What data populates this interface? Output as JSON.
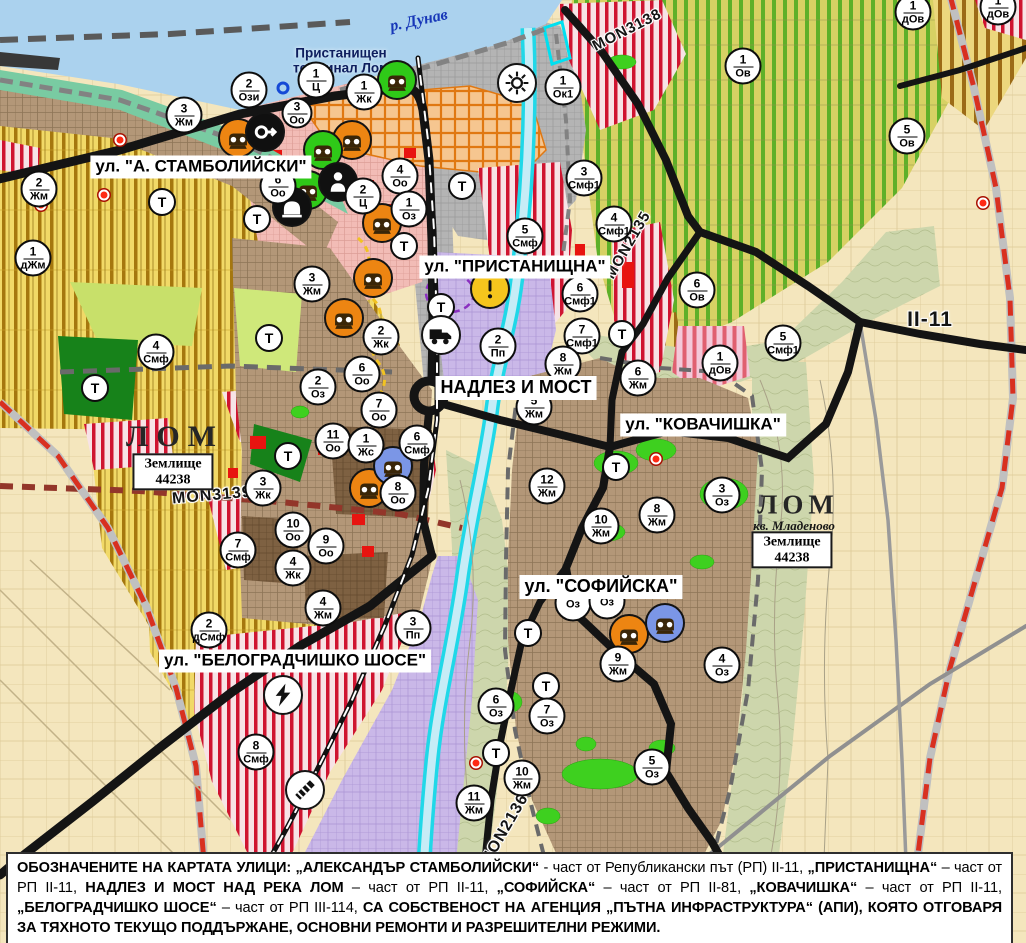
{
  "street_labels": [
    {
      "text": "ул. \"А. СТАМБОЛИЙСКИ\"",
      "x": 201,
      "y": 167,
      "fs": 17,
      "name": "street-label-stamboliyski"
    },
    {
      "text": "ул. \"ПРИСТАНИЩНА\"",
      "x": 515,
      "y": 267,
      "fs": 17,
      "name": "street-label-pristanishtna"
    },
    {
      "text": "НАДЛЕЗ И МОСТ",
      "x": 516,
      "y": 388,
      "fs": 18,
      "name": "street-label-nadlez-i-most"
    },
    {
      "text": "ул. \"КОВАЧИШКА\"",
      "x": 703,
      "y": 425,
      "fs": 17,
      "name": "street-label-kovachishka"
    },
    {
      "text": "ул. \"СОФИЙСКА\"",
      "x": 601,
      "y": 587,
      "fs": 18,
      "name": "street-label-sofiyska"
    },
    {
      "text": "ул. \"БЕЛОГРАДЧИШКО ШОСЕ\"",
      "x": 295,
      "y": 661,
      "fs": 17,
      "name": "street-label-belogradchishko"
    }
  ],
  "road_labels": [
    {
      "text": "MON3139",
      "x": 212,
      "y": 496,
      "rot": -5,
      "fs": 16,
      "name": "road-code-mon3139"
    },
    {
      "text": "MON2135",
      "x": 628,
      "y": 245,
      "rot": -60,
      "fs": 15,
      "name": "road-code-mon2135"
    },
    {
      "text": "MON3138",
      "x": 627,
      "y": 30,
      "rot": -27,
      "fs": 15,
      "name": "road-code-mon3138"
    },
    {
      "text": "II-11",
      "x": 930,
      "y": 320,
      "rot": 0,
      "fs": 21,
      "name": "road-code-ii-11"
    },
    {
      "text": "MON2136",
      "x": 505,
      "y": 830,
      "rot": -60,
      "fs": 16,
      "name": "road-code-mon2136"
    }
  ],
  "place_labels": [
    {
      "text": "р. Дунав",
      "x": 419,
      "y": 21,
      "rot": -12,
      "fs": 16,
      "cls": "pl-river",
      "name": "river-danube-label"
    },
    {
      "text": "Пристанищен\nтерминал Лом",
      "x": 341,
      "y": 53,
      "fs": 13.5,
      "cls": "pl-terminal",
      "name": "port-terminal-label"
    },
    {
      "text": "ЛОМ",
      "x": 175,
      "y": 437,
      "fs": 30,
      "ls": 8,
      "cls": "pl-city",
      "name": "city-label-lom-west"
    },
    {
      "text": "ЛОМ",
      "x": 798,
      "y": 505,
      "fs": 27,
      "ls": 5,
      "cls": "pl-city",
      "name": "city-label-lom-east"
    },
    {
      "text": "кв. Младеново",
      "x": 794,
      "y": 526,
      "fs": 13,
      "cls": "pl-kv",
      "name": "kvartal-mladenovo-label"
    }
  ],
  "zemlishte_boxes": [
    {
      "x": 173,
      "y": 472,
      "line1": "Землище",
      "line2": "44238"
    },
    {
      "x": 792,
      "y": 550,
      "line1": "Землище",
      "line2": "44238"
    }
  ],
  "zone_markers": [
    {
      "x": 249,
      "y": 90,
      "n": "2",
      "c": "Ози"
    },
    {
      "x": 316,
      "y": 80,
      "n": "1",
      "c": "Ц"
    },
    {
      "x": 297,
      "y": 113,
      "n": "3",
      "c": "Оо",
      "cls": "sm"
    },
    {
      "x": 364,
      "y": 92,
      "n": "1",
      "c": "Жк"
    },
    {
      "x": 563,
      "y": 87,
      "n": "1",
      "c": "Ок1"
    },
    {
      "x": 184,
      "y": 115,
      "n": "3",
      "c": "Жм"
    },
    {
      "x": 400,
      "y": 176,
      "n": "4",
      "c": "Оо"
    },
    {
      "x": 363,
      "y": 196,
      "n": "2",
      "c": "Ц"
    },
    {
      "x": 409,
      "y": 209,
      "n": "1",
      "c": "Оз"
    },
    {
      "x": 278,
      "y": 186,
      "n": "6",
      "c": "Оо"
    },
    {
      "x": 39,
      "y": 189,
      "n": "2",
      "c": "Жм"
    },
    {
      "x": 33,
      "y": 258,
      "n": "1",
      "c": "дЖм"
    },
    {
      "x": 312,
      "y": 284,
      "n": "3",
      "c": "Жм"
    },
    {
      "x": 381,
      "y": 337,
      "n": "2",
      "c": "Жк"
    },
    {
      "x": 362,
      "y": 374,
      "n": "6",
      "c": "Оо"
    },
    {
      "x": 379,
      "y": 410,
      "n": "7",
      "c": "Оо"
    },
    {
      "x": 318,
      "y": 387,
      "n": "2",
      "c": "Оз"
    },
    {
      "x": 333,
      "y": 441,
      "n": "11",
      "c": "Оо"
    },
    {
      "x": 366,
      "y": 445,
      "n": "1",
      "c": "Жс"
    },
    {
      "x": 417,
      "y": 443,
      "n": "6",
      "c": "Смф"
    },
    {
      "x": 398,
      "y": 493,
      "n": "8",
      "c": "Оо"
    },
    {
      "x": 263,
      "y": 488,
      "n": "3",
      "c": "Жк"
    },
    {
      "x": 293,
      "y": 530,
      "n": "10",
      "c": "Оо"
    },
    {
      "x": 326,
      "y": 546,
      "n": "9",
      "c": "Оо"
    },
    {
      "x": 293,
      "y": 568,
      "n": "4",
      "c": "Жк"
    },
    {
      "x": 238,
      "y": 550,
      "n": "7",
      "c": "Смф"
    },
    {
      "x": 156,
      "y": 352,
      "n": "4",
      "c": "Смф"
    },
    {
      "x": 913,
      "y": 12,
      "n": "1",
      "c": "дОв"
    },
    {
      "x": 998,
      "y": 7,
      "n": "1",
      "c": "дОв"
    },
    {
      "x": 743,
      "y": 66,
      "n": "1",
      "c": "Ов"
    },
    {
      "x": 907,
      "y": 136,
      "n": "5",
      "c": "Ов"
    },
    {
      "x": 584,
      "y": 178,
      "n": "3",
      "c": "Смф1"
    },
    {
      "x": 614,
      "y": 224,
      "n": "4",
      "c": "Смф1"
    },
    {
      "x": 525,
      "y": 236,
      "n": "5",
      "c": "Смф"
    },
    {
      "x": 580,
      "y": 294,
      "n": "6",
      "c": "Смф1"
    },
    {
      "x": 582,
      "y": 336,
      "n": "7",
      "c": "Смф1"
    },
    {
      "x": 697,
      "y": 290,
      "n": "6",
      "c": "Ов"
    },
    {
      "x": 720,
      "y": 363,
      "n": "1",
      "c": "дОв"
    },
    {
      "x": 783,
      "y": 343,
      "n": "5",
      "c": "Смф1"
    },
    {
      "x": 498,
      "y": 346,
      "n": "2",
      "c": "Пп"
    },
    {
      "x": 534,
      "y": 407,
      "n": "5",
      "c": "Жм"
    },
    {
      "x": 563,
      "y": 364,
      "n": "8",
      "c": "Жм"
    },
    {
      "x": 638,
      "y": 378,
      "n": "6",
      "c": "Жм"
    },
    {
      "x": 547,
      "y": 486,
      "n": "12",
      "c": "Жм"
    },
    {
      "x": 601,
      "y": 526,
      "n": "10",
      "c": "Жм"
    },
    {
      "x": 657,
      "y": 515,
      "n": "8",
      "c": "Жм"
    },
    {
      "x": 722,
      "y": 495,
      "n": "3",
      "c": "Оз"
    },
    {
      "x": 618,
      "y": 664,
      "n": "9",
      "c": "Жм"
    },
    {
      "x": 722,
      "y": 665,
      "n": "4",
      "c": "Оз"
    },
    {
      "x": 496,
      "y": 706,
      "n": "6",
      "c": "Оз"
    },
    {
      "x": 547,
      "y": 716,
      "n": "7",
      "c": "Оз"
    },
    {
      "x": 652,
      "y": 767,
      "n": "5",
      "c": "Оз"
    },
    {
      "x": 522,
      "y": 778,
      "n": "10",
      "c": "Жм"
    },
    {
      "x": 474,
      "y": 803,
      "n": "11",
      "c": "Жм"
    },
    {
      "x": 209,
      "y": 630,
      "n": "2",
      "c": "дСмф"
    },
    {
      "x": 323,
      "y": 608,
      "n": "4",
      "c": "Жм"
    },
    {
      "x": 413,
      "y": 628,
      "n": "3",
      "c": "Пп"
    },
    {
      "x": 256,
      "y": 752,
      "n": "8",
      "c": "Смф"
    },
    {
      "x": 573,
      "y": 603,
      "n": "",
      "c": "Оз"
    },
    {
      "x": 607,
      "y": 601,
      "n": "",
      "c": "Оз"
    }
  ],
  "t_markers": [
    {
      "x": 162,
      "y": 202,
      "l": "Т"
    },
    {
      "x": 257,
      "y": 219,
      "l": "Т"
    },
    {
      "x": 269,
      "y": 338,
      "l": "Т"
    },
    {
      "x": 95,
      "y": 388,
      "l": "Т"
    },
    {
      "x": 288,
      "y": 456,
      "l": "Т"
    },
    {
      "x": 462,
      "y": 186,
      "l": "Т"
    },
    {
      "x": 404,
      "y": 246,
      "l": "Т"
    },
    {
      "x": 441,
      "y": 307,
      "l": "Т"
    },
    {
      "x": 622,
      "y": 334,
      "l": "Т"
    },
    {
      "x": 616,
      "y": 467,
      "l": "Т"
    },
    {
      "x": 528,
      "y": 633,
      "l": "Т"
    },
    {
      "x": 546,
      "y": 686,
      "l": "Т"
    },
    {
      "x": 496,
      "y": 753,
      "l": "Т"
    }
  ],
  "icon_markers": [
    {
      "x": 238,
      "y": 138,
      "icon": "factory",
      "bg": "#ed8512",
      "name": "factory-icon-marker"
    },
    {
      "x": 352,
      "y": 140,
      "icon": "factory",
      "bg": "#ed8512",
      "name": "factory-icon-marker"
    },
    {
      "x": 382,
      "y": 223,
      "icon": "factory",
      "bg": "#ed8512",
      "name": "factory-icon-marker"
    },
    {
      "x": 373,
      "y": 278,
      "icon": "factory",
      "bg": "#ed8512",
      "name": "factory-icon-marker"
    },
    {
      "x": 344,
      "y": 318,
      "icon": "factory",
      "bg": "#ed8512",
      "name": "factory-icon-marker"
    },
    {
      "x": 369,
      "y": 488,
      "icon": "factory",
      "bg": "#ed8512",
      "name": "factory-icon-marker"
    },
    {
      "x": 629,
      "y": 634,
      "icon": "factory",
      "bg": "#ed8512",
      "name": "factory-icon-marker"
    },
    {
      "x": 397,
      "y": 80,
      "icon": "factory",
      "bg": "#2fc918",
      "name": "factory-icon-marker-green"
    },
    {
      "x": 323,
      "y": 150,
      "icon": "factory",
      "bg": "#2fc918",
      "name": "factory-icon-marker-green"
    },
    {
      "x": 308,
      "y": 190,
      "icon": "factory",
      "bg": "#2fc918",
      "name": "factory-icon-marker-green"
    },
    {
      "x": 393,
      "y": 466,
      "icon": "factory",
      "bg": "#7b96e6",
      "name": "factory-icon-marker-blue"
    },
    {
      "x": 665,
      "y": 623,
      "icon": "factory",
      "bg": "#7b96e6",
      "name": "factory-icon-marker-blue"
    },
    {
      "x": 265,
      "y": 132,
      "icon": "key",
      "bg": "#101010",
      "name": "monument-icon-marker"
    },
    {
      "x": 338,
      "y": 182,
      "icon": "person",
      "bg": "#101010",
      "name": "person-icon-marker"
    },
    {
      "x": 292,
      "y": 207,
      "icon": "tunnel",
      "bg": "#101010",
      "name": "tunnel-icon-marker"
    },
    {
      "x": 517,
      "y": 83,
      "icon": "sun",
      "bg": "#ffffff",
      "name": "sun-icon-marker"
    },
    {
      "x": 490,
      "y": 289,
      "icon": "warning",
      "bg": "#f5c51d",
      "name": "warning-icon-marker"
    },
    {
      "x": 441,
      "y": 335,
      "icon": "truck",
      "bg": "#ffffff",
      "name": "truck-station-icon-marker"
    },
    {
      "x": 283,
      "y": 695,
      "icon": "lightning",
      "bg": "#ffffff",
      "name": "electric-substation-icon-marker"
    },
    {
      "x": 305,
      "y": 790,
      "icon": "crossing",
      "bg": "#ffffff",
      "name": "railway-crossing-icon-marker"
    }
  ],
  "dots": [
    {
      "x": 120,
      "y": 140,
      "cls": "red"
    },
    {
      "x": 41,
      "y": 205,
      "cls": "red"
    },
    {
      "x": 104,
      "y": 195,
      "cls": "red"
    },
    {
      "x": 656,
      "y": 459,
      "cls": "red"
    },
    {
      "x": 983,
      "y": 203,
      "cls": "red"
    },
    {
      "x": 476,
      "y": 763,
      "cls": "red"
    },
    {
      "x": 283,
      "y": 88,
      "cls": "blue"
    }
  ],
  "footer": {
    "segments": [
      {
        "t": "ОБОЗНАЧЕНИТЕ НА КАРТАТА УЛИЦИ: „АЛЕКСАНДЪР СТАМБОЛИЙСКИ“",
        "cls": "b"
      },
      {
        "t": " - част от Републикански път (РП) II-11, "
      },
      {
        "t": "„ПРИСТАНИЩНА“",
        "cls": "b"
      },
      {
        "t": " – част от РП II-11, "
      },
      {
        "t": "НАДЛЕЗ И МОСТ НАД РЕКА ЛОМ",
        "cls": "b"
      },
      {
        "t": " – част от РП II-11, "
      },
      {
        "t": "„СОФИЙСКА“",
        "cls": "b"
      },
      {
        "t": " – част от РП II-81, "
      },
      {
        "t": "„КОВАЧИШКА“",
        "cls": "b"
      },
      {
        "t": " – част от РП II-11, "
      },
      {
        "t": "„БЕЛОГРАДЧИШКО ШОСЕ“",
        "cls": "b"
      },
      {
        "t": " – част от РП III-114, "
      },
      {
        "t": "СА СОБСТВЕНОСТ НА АГЕНЦИЯ „ПЪТНА ИНФРАСТРУКТУРА“ (АПИ), КОЯТО ОТГОВАРЯ ЗА ТЯХНОТО ТЕКУЩО ПОДДЪРЖАНЕ, ОСНОВНИ РЕМОНТИ И РАЗРЕШИТЕЛНИ РЕЖИМИ.",
        "cls": "b"
      }
    ]
  },
  "colors": {
    "water": "#abd2ee",
    "river": "#20d8e8",
    "border_red": "#d83020",
    "road_black": "#141414",
    "park_green": "#3ed01f"
  }
}
